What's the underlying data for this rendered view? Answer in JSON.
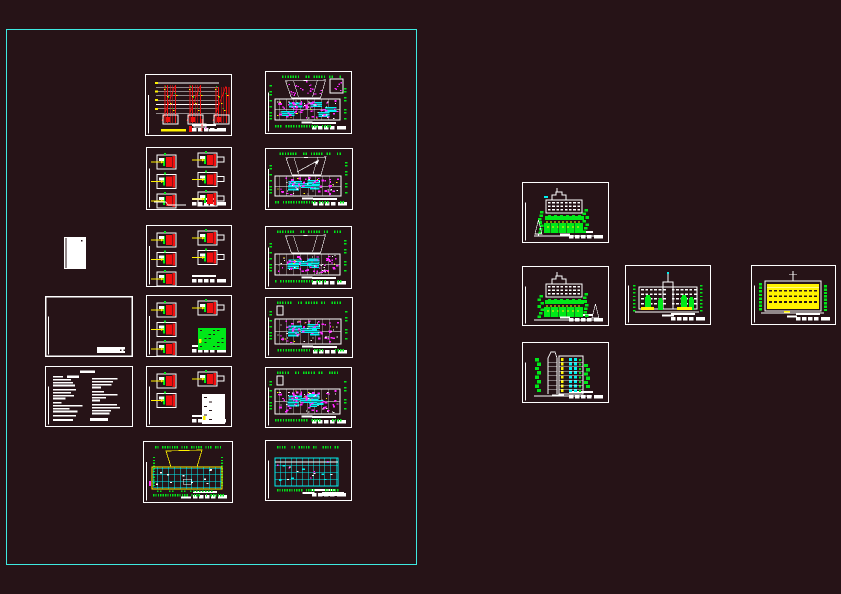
{
  "canvas": {
    "width": 841,
    "height": 594,
    "background": "#261317",
    "description": "cad-workspace-with-drawing-sheets"
  },
  "selection_rect": {
    "x": 6,
    "y": 29,
    "w": 411,
    "h": 536,
    "color": "#3EE9E0"
  },
  "palette": {
    "background": "#261317",
    "frame_white": "#FFFFFF",
    "cad_red": "#F01010",
    "cad_green": "#00E818",
    "cad_yellow": "#FFF200",
    "cad_cyan": "#00F0F0",
    "cad_magenta": "#FF28FF",
    "selection_cyan": "#3EE9E0"
  },
  "sheets": [
    {
      "id": "blank-card",
      "kind": "card",
      "x": 64,
      "y": 237,
      "w": 22,
      "h": 32,
      "seed": 1,
      "opts": {}
    },
    {
      "id": "empty-frame",
      "kind": "empty",
      "x": 45,
      "y": 296,
      "w": 88,
      "h": 61,
      "seed": 2,
      "opts": {}
    },
    {
      "id": "notes-sheet",
      "kind": "notes",
      "x": 45,
      "y": 366,
      "w": 88,
      "h": 61,
      "seed": 3,
      "opts": {}
    },
    {
      "id": "riser-diagram",
      "kind": "riser",
      "x": 145,
      "y": 74,
      "w": 87,
      "h": 62,
      "seed": 4,
      "opts": {}
    },
    {
      "id": "detail-sheet-1",
      "kind": "details",
      "x": 146,
      "y": 147,
      "w": 86,
      "h": 63,
      "seed": 5,
      "opts": {
        "left": 3,
        "right": 3,
        "steps": true
      }
    },
    {
      "id": "detail-sheet-2",
      "kind": "details",
      "x": 146,
      "y": 225,
      "w": 86,
      "h": 62,
      "seed": 6,
      "opts": {
        "left": 3,
        "right": 2
      }
    },
    {
      "id": "detail-sheet-3",
      "kind": "details",
      "x": 146,
      "y": 295,
      "w": 86,
      "h": 62,
      "seed": 7,
      "opts": {
        "left": 3,
        "right": 1,
        "panel": "green"
      }
    },
    {
      "id": "detail-sheet-4",
      "kind": "details",
      "x": 146,
      "y": 366,
      "w": 86,
      "h": 61,
      "seed": 8,
      "opts": {
        "left": 2,
        "right": 1,
        "panel": "white"
      }
    },
    {
      "id": "plan-ground",
      "kind": "planYellow",
      "x": 143,
      "y": 441,
      "w": 90,
      "h": 62,
      "seed": 9,
      "opts": {}
    },
    {
      "id": "plan-1",
      "kind": "plan",
      "x": 265,
      "y": 71,
      "w": 87,
      "h": 63,
      "seed": 10,
      "opts": {
        "fan": true,
        "fanDots": true,
        "box": true,
        "cyan": 5,
        "mag": 55
      }
    },
    {
      "id": "plan-2",
      "kind": "plan",
      "x": 265,
      "y": 148,
      "w": 88,
      "h": 62,
      "seed": 11,
      "opts": {
        "fan": true,
        "arrow": true,
        "cyan": 6,
        "mag": 40
      }
    },
    {
      "id": "plan-3",
      "kind": "plan",
      "x": 265,
      "y": 226,
      "w": 87,
      "h": 63,
      "seed": 12,
      "opts": {
        "fan": true,
        "cyan": 7,
        "mag": 45
      }
    },
    {
      "id": "plan-4",
      "kind": "plan",
      "x": 265,
      "y": 297,
      "w": 88,
      "h": 61,
      "seed": 13,
      "opts": {
        "lshape": true,
        "cyan": 6,
        "mag": 45
      }
    },
    {
      "id": "plan-5",
      "kind": "plan",
      "x": 265,
      "y": 367,
      "w": 87,
      "h": 61,
      "seed": 14,
      "opts": {
        "lshape": true,
        "cyan": 9,
        "mag": 60
      }
    },
    {
      "id": "plan-6",
      "kind": "planCyan",
      "x": 265,
      "y": 440,
      "w": 87,
      "h": 61,
      "seed": 15,
      "opts": {}
    },
    {
      "id": "elevation-1",
      "kind": "elevGreen",
      "x": 522,
      "y": 182,
      "w": 87,
      "h": 61,
      "seed": 16,
      "opts": {
        "cyanFlag": true
      }
    },
    {
      "id": "elevation-2",
      "kind": "elevGreen",
      "x": 522,
      "y": 266,
      "w": 87,
      "h": 60,
      "seed": 17,
      "opts": {
        "mirror": true
      }
    },
    {
      "id": "elevation-3",
      "kind": "elevFront",
      "x": 625,
      "y": 265,
      "w": 86,
      "h": 60,
      "seed": 18,
      "opts": {}
    },
    {
      "id": "elevation-4",
      "kind": "elevYellow",
      "x": 751,
      "y": 265,
      "w": 85,
      "h": 60,
      "seed": 19,
      "opts": {}
    },
    {
      "id": "section-sheet",
      "kind": "section",
      "x": 522,
      "y": 342,
      "w": 87,
      "h": 61,
      "seed": 20,
      "opts": {}
    }
  ]
}
